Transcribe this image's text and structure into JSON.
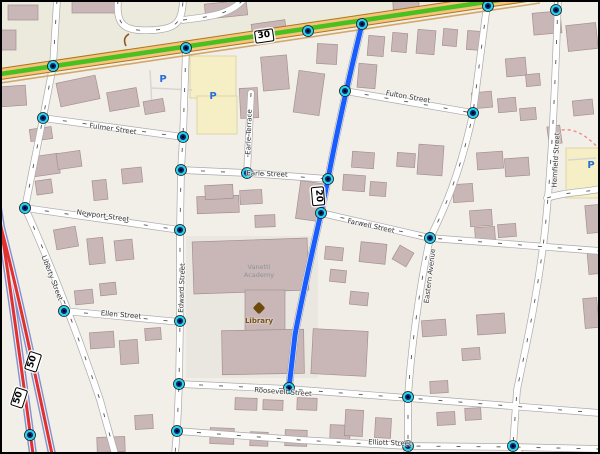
{
  "map": {
    "shields": [
      {
        "ref": "30",
        "x": 264,
        "y": 36,
        "rot": -8
      },
      {
        "ref": "20",
        "x": 318,
        "y": 196,
        "rot": 85
      },
      {
        "ref": "50",
        "x": 33,
        "y": 362,
        "rot": -72
      },
      {
        "ref": "50",
        "x": 19,
        "y": 398,
        "rot": -72
      }
    ],
    "street_labels": [
      {
        "text": "Fulmer Street",
        "x": 113,
        "y": 129,
        "rot": 8
      },
      {
        "text": "Newport Street",
        "x": 103,
        "y": 216,
        "rot": 8
      },
      {
        "text": "Ellen Street",
        "x": 121,
        "y": 315,
        "rot": 5
      },
      {
        "text": "Liberty Street",
        "x": 52,
        "y": 278,
        "rot": 69
      },
      {
        "text": "Edward Street",
        "x": 182,
        "y": 288,
        "rot": -88
      },
      {
        "text": "Earle Terrace",
        "x": 249,
        "y": 132,
        "rot": -88
      },
      {
        "text": "Earle Street",
        "x": 267,
        "y": 174,
        "rot": 2
      },
      {
        "text": "Fulton Street",
        "x": 408,
        "y": 97,
        "rot": 10
      },
      {
        "text": "Farwell Street",
        "x": 371,
        "y": 226,
        "rot": 12
      },
      {
        "text": "Eastern Avenue",
        "x": 430,
        "y": 276,
        "rot": -83
      },
      {
        "text": "Hemfield Street",
        "x": 556,
        "y": 160,
        "rot": -87
      },
      {
        "text": "Roosevelt Street",
        "x": 283,
        "y": 392,
        "rot": 4
      },
      {
        "text": "Elliott Street",
        "x": 390,
        "y": 443,
        "rot": 2
      }
    ],
    "pois": [
      {
        "type": "library",
        "label": "Library",
        "x": 259,
        "y": 321,
        "icon_x": 259,
        "icon_y": 308
      },
      {
        "type": "building-label",
        "label": "Vanetti Academy",
        "x": 259,
        "y": 272
      }
    ],
    "parking": {
      "symbol": "P",
      "positions": [
        {
          "x": 163,
          "y": 80
        },
        {
          "x": 213,
          "y": 97
        },
        {
          "x": 591,
          "y": 166
        }
      ]
    },
    "nodes": [
      [
        53,
        66
      ],
      [
        186,
        48
      ],
      [
        308,
        31
      ],
      [
        362,
        24
      ],
      [
        488,
        6
      ],
      [
        556,
        10
      ],
      [
        345,
        91
      ],
      [
        328,
        179
      ],
      [
        321,
        213
      ],
      [
        289,
        388
      ],
      [
        183,
        137
      ],
      [
        181,
        170
      ],
      [
        180,
        230
      ],
      [
        180,
        321
      ],
      [
        179,
        384
      ],
      [
        177,
        431
      ],
      [
        43,
        118
      ],
      [
        25,
        208
      ],
      [
        64,
        311
      ],
      [
        247,
        173
      ],
      [
        473,
        113
      ],
      [
        430,
        238
      ],
      [
        408,
        397
      ],
      [
        408,
        446
      ],
      [
        513,
        446
      ],
      [
        30,
        435
      ]
    ],
    "colors": {
      "selected_route_blue": "#1a5dff",
      "selected_route_green": "#47c020",
      "motorway_red": "#e03030",
      "motorway_casing": "#8292cc",
      "main_road_fill": "#f9c37f",
      "main_road_casing": "#a87818",
      "node_ring": "#29d2e9",
      "node_core": "#0d2368",
      "building_fill": "#c9b7b7",
      "parking_blue": "#2a6fd6",
      "library_brown": "#7a4f12",
      "background": "#f2efe9"
    }
  }
}
